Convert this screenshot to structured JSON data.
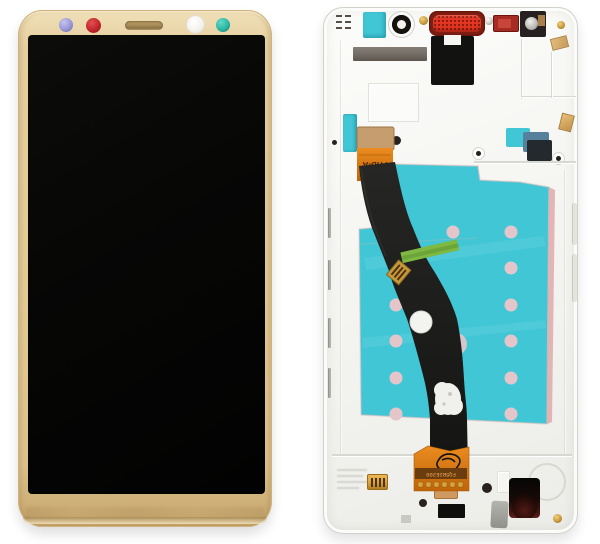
{
  "labels": {
    "flex_cable_label": "FHD-A",
    "connector_code": "FQ5B2E200"
  },
  "colors": {
    "gold-frame": "#e6cfa0",
    "gold-dark": "#c3a261",
    "screen-black": "#070706",
    "camera-lavender": "#9a97d7",
    "dot-red": "#c2252c",
    "dot-teal": "#2cb7a5",
    "sensor-white": "#f3f1ec",
    "speaker-gold": "#a98e5b",
    "frame-white": "#f8f8f6",
    "frame-line": "#d9d9d3",
    "adhesive-teal": "#41c6d6",
    "adhesive-gray": "#746e67",
    "earpiece-red": "#e23622",
    "earpiece-dark-red": "#7e1d12",
    "flex-orange": "#e07a14",
    "flex-tan": "#c59d6e",
    "cable-black": "#1b1a18",
    "pink-dot": "#e4c6ca",
    "green-tape": "#7fb944",
    "gold-contact": "#d8a33e"
  }
}
